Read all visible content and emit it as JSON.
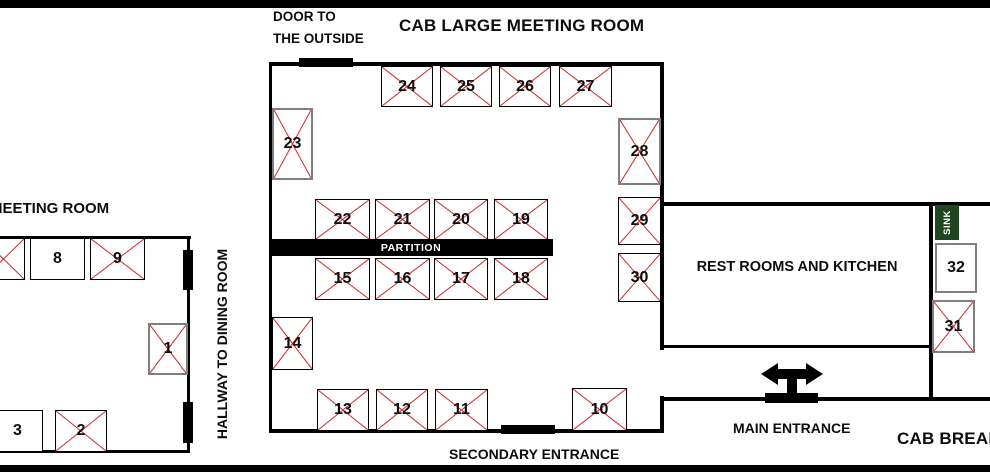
{
  "diagram": {
    "large_room_title": "CAB LARGE MEETING ROOM",
    "small_room_title": "MEETING ROOM",
    "break_room_title": "CAB BREAK",
    "door_outside_line1": "DOOR TO",
    "door_outside_line2": "THE OUTSIDE",
    "hallway_label": "HALLWAY TO DINING ROOM",
    "partition_label": "PARTITION",
    "restrooms_label": "REST ROOMS AND KITCHEN",
    "sink_label": "SINK",
    "main_entrance_label": "MAIN ENTRANCE",
    "secondary_entrance_label": "SECONDARY ENTRANCE"
  },
  "colors": {
    "cross_red": "#cc2929",
    "sink_green": "#1e4620",
    "wall": "#000000",
    "gray_border": "#7f7f7f"
  },
  "tables": [
    {
      "label": "",
      "x": -18,
      "y": 238,
      "w": 43,
      "h": 42,
      "crossed": true,
      "gray": false
    },
    {
      "label": "8",
      "x": 30,
      "y": 238,
      "w": 55,
      "h": 42,
      "crossed": false,
      "gray": false
    },
    {
      "label": "9",
      "x": 90,
      "y": 238,
      "w": 55,
      "h": 42,
      "crossed": true,
      "gray": false
    },
    {
      "label": "1",
      "x": 148,
      "y": 323,
      "w": 40,
      "h": 52,
      "crossed": true,
      "gray": true
    },
    {
      "label": "3",
      "x": -8,
      "y": 410,
      "w": 51,
      "h": 42,
      "crossed": false,
      "gray": false
    },
    {
      "label": "2",
      "x": 55,
      "y": 410,
      "w": 52,
      "h": 42,
      "crossed": true,
      "gray": false
    },
    {
      "label": "23",
      "x": 272,
      "y": 108,
      "w": 41,
      "h": 72,
      "crossed": true,
      "gray": true
    },
    {
      "label": "24",
      "x": 381,
      "y": 66,
      "w": 52,
      "h": 41,
      "crossed": true,
      "gray": false
    },
    {
      "label": "25",
      "x": 440,
      "y": 66,
      "w": 52,
      "h": 41,
      "crossed": true,
      "gray": false
    },
    {
      "label": "26",
      "x": 499,
      "y": 66,
      "w": 52,
      "h": 41,
      "crossed": true,
      "gray": false
    },
    {
      "label": "27",
      "x": 559,
      "y": 66,
      "w": 53,
      "h": 41,
      "crossed": true,
      "gray": false
    },
    {
      "label": "28",
      "x": 618,
      "y": 118,
      "w": 43,
      "h": 67,
      "crossed": true,
      "gray": true
    },
    {
      "label": "29",
      "x": 618,
      "y": 197,
      "w": 43,
      "h": 48,
      "crossed": true,
      "gray": false
    },
    {
      "label": "30",
      "x": 618,
      "y": 253,
      "w": 43,
      "h": 49,
      "crossed": true,
      "gray": false
    },
    {
      "label": "22",
      "x": 315,
      "y": 199,
      "w": 55,
      "h": 41,
      "crossed": true,
      "gray": false
    },
    {
      "label": "21",
      "x": 375,
      "y": 199,
      "w": 55,
      "h": 41,
      "crossed": true,
      "gray": false
    },
    {
      "label": "20",
      "x": 434,
      "y": 199,
      "w": 54,
      "h": 41,
      "crossed": true,
      "gray": false
    },
    {
      "label": "19",
      "x": 494,
      "y": 199,
      "w": 54,
      "h": 41,
      "crossed": true,
      "gray": false
    },
    {
      "label": "15",
      "x": 315,
      "y": 258,
      "w": 55,
      "h": 42,
      "crossed": true,
      "gray": false
    },
    {
      "label": "16",
      "x": 375,
      "y": 258,
      "w": 55,
      "h": 42,
      "crossed": true,
      "gray": false
    },
    {
      "label": "17",
      "x": 434,
      "y": 258,
      "w": 54,
      "h": 42,
      "crossed": true,
      "gray": false
    },
    {
      "label": "18",
      "x": 494,
      "y": 258,
      "w": 54,
      "h": 42,
      "crossed": true,
      "gray": false
    },
    {
      "label": "14",
      "x": 272,
      "y": 317,
      "w": 41,
      "h": 53,
      "crossed": true,
      "gray": false
    },
    {
      "label": "13",
      "x": 317,
      "y": 389,
      "w": 52,
      "h": 42,
      "crossed": true,
      "gray": false
    },
    {
      "label": "12",
      "x": 376,
      "y": 389,
      "w": 52,
      "h": 42,
      "crossed": true,
      "gray": false
    },
    {
      "label": "11",
      "x": 435,
      "y": 389,
      "w": 53,
      "h": 42,
      "crossed": true,
      "gray": false
    },
    {
      "label": "10",
      "x": 572,
      "y": 388,
      "w": 55,
      "h": 43,
      "crossed": true,
      "gray": false
    },
    {
      "label": "32",
      "x": 935,
      "y": 243,
      "w": 42,
      "h": 50,
      "crossed": false,
      "gray": true
    },
    {
      "label": "31",
      "x": 932,
      "y": 300,
      "w": 43,
      "h": 53,
      "crossed": true,
      "gray": true
    }
  ]
}
